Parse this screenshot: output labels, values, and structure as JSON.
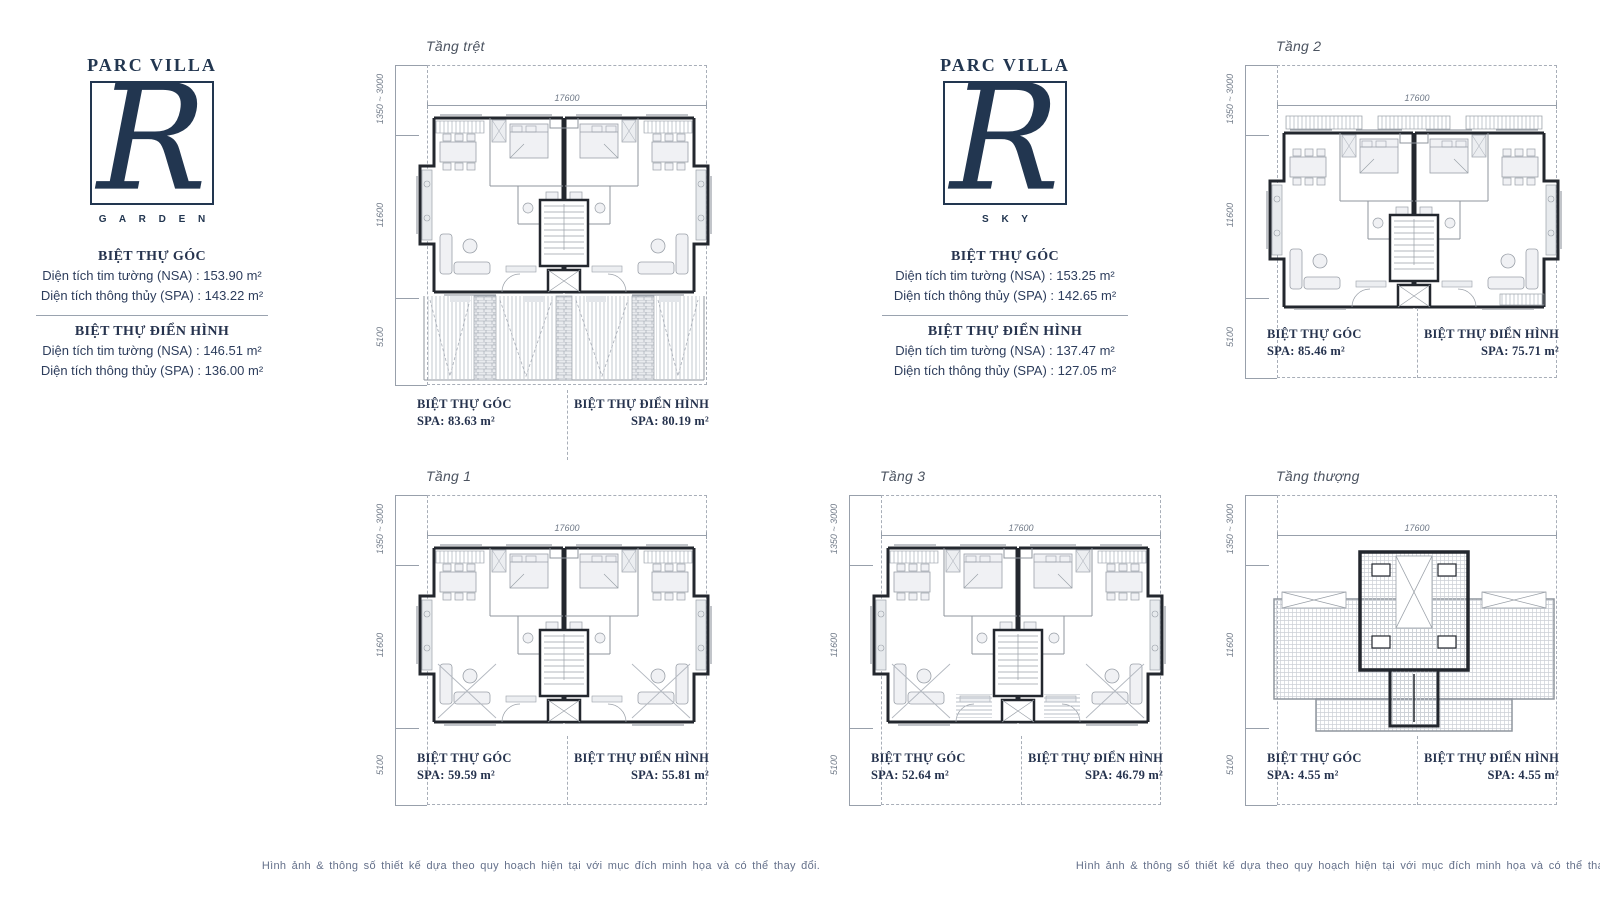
{
  "page": {
    "disclaimer": "Hình ảnh & thông số thiết kế dựa theo quy hoạch hiện tại với mục đích minh họa và có thể thay đổi."
  },
  "brands": [
    {
      "name": "PARC VILLA",
      "letter": "R",
      "variant": "G A R D E N",
      "sections": [
        {
          "title": "BIỆT THỰ GÓC",
          "lines": [
            "Diện tích tim tường (NSA) : 153.90 m²",
            "Diện tích thông thủy (SPA) : 143.22 m²"
          ]
        },
        {
          "title": "BIỆT THỰ ĐIỂN HÌNH",
          "lines": [
            "Diện tích tim tường (NSA) : 146.51 m²",
            "Diện tích thông thủy (SPA) : 136.00 m²"
          ]
        }
      ]
    },
    {
      "name": "PARC VILLA",
      "letter": "R",
      "variant": "S K Y",
      "sections": [
        {
          "title": "BIỆT THỰ GÓC",
          "lines": [
            "Diện tích tim tường (NSA) : 153.25 m²",
            "Diện tích thông thủy (SPA) : 142.65 m²"
          ]
        },
        {
          "title": "BIỆT THỰ ĐIỂN HÌNH",
          "lines": [
            "Diện tích tim tường (NSA) : 137.47 m²",
            "Diện tích thông thủy (SPA) : 127.05 m²"
          ]
        }
      ]
    }
  ],
  "dims": {
    "width": "17600",
    "left": [
      "1350 ~ 3000",
      "11600",
      "5100"
    ]
  },
  "plans": [
    {
      "title": "Tầng trệt",
      "units": [
        {
          "name": "BIỆT THỰ GÓC",
          "spa": "SPA: 83.63 m²"
        },
        {
          "name": "BIỆT THỰ ĐIỂN HÌNH",
          "spa": "SPA: 80.19 m²"
        }
      ]
    },
    {
      "title": "Tầng 2",
      "units": [
        {
          "name": "BIỆT THỰ GÓC",
          "spa": "SPA: 85.46 m²"
        },
        {
          "name": "BIỆT THỰ ĐIỂN HÌNH",
          "spa": "SPA: 75.71 m²"
        }
      ]
    },
    {
      "title": "Tầng 1",
      "units": [
        {
          "name": "BIỆT THỰ GÓC",
          "spa": "SPA: 59.59 m²"
        },
        {
          "name": "BIỆT THỰ ĐIỂN HÌNH",
          "spa": "SPA: 55.81 m²"
        }
      ]
    },
    {
      "title": "Tầng 3",
      "units": [
        {
          "name": "BIỆT THỰ GÓC",
          "spa": "SPA: 52.64 m²"
        },
        {
          "name": "BIỆT THỰ ĐIỂN HÌNH",
          "spa": "SPA: 46.79 m²"
        }
      ]
    },
    {
      "title": "Tầng thượng",
      "units": [
        {
          "name": "BIỆT THỰ GÓC",
          "spa": "SPA: 4.55 m²"
        },
        {
          "name": "BIỆT THỰ ĐIỂN HÌNH",
          "spa": "SPA: 4.55 m²"
        }
      ]
    }
  ]
}
